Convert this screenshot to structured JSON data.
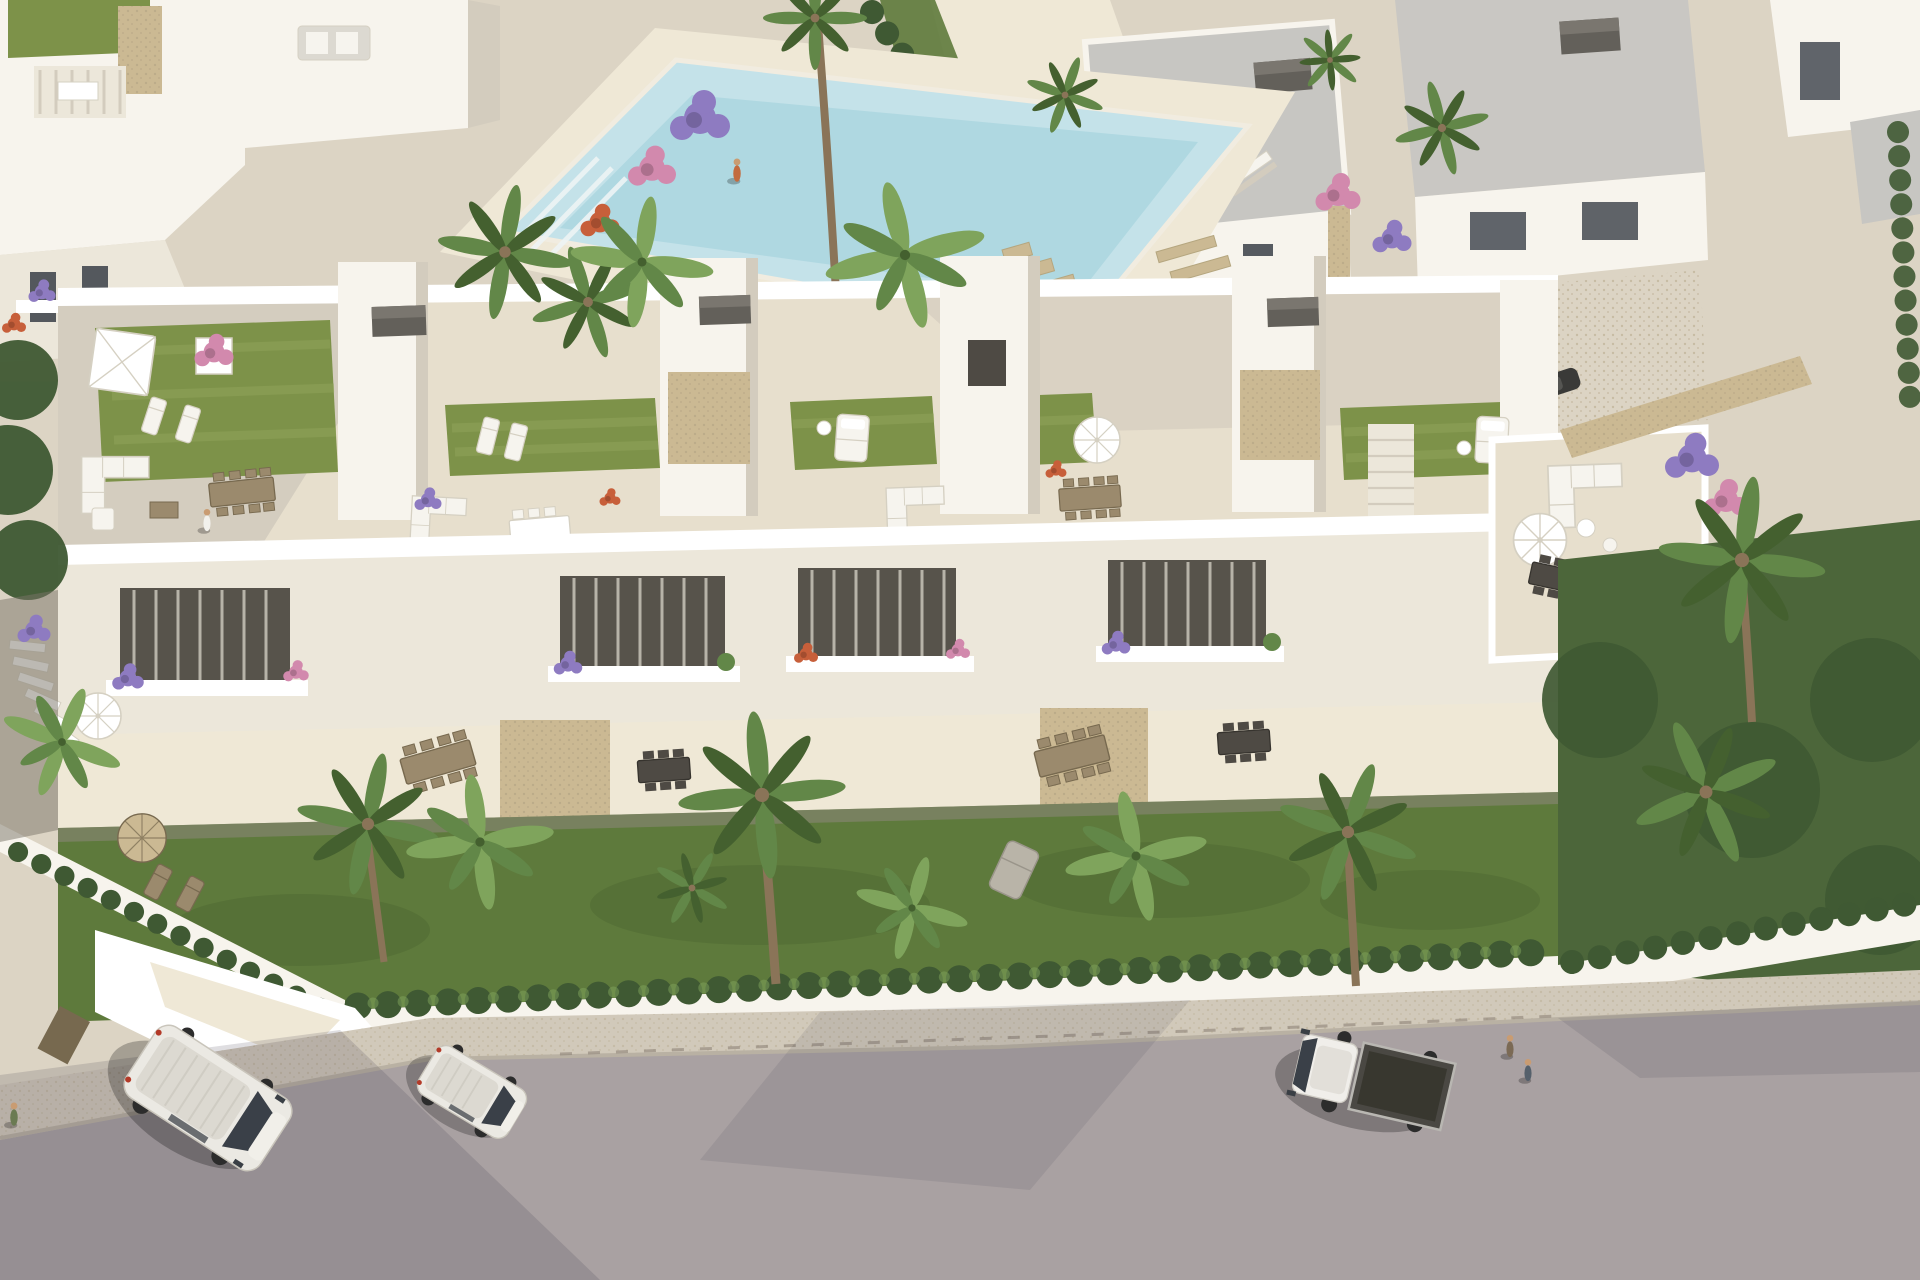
{
  "meta": {
    "content_type": "aerial-architectural-render",
    "description": "High-angle aerial 3D visualization of a modern white residential complex: a row of townhouses with landscaped roof terraces, balcony level with flower planters, ground-floor terraces and private gardens, a communal swimming pool with palm landscaping behind, surrounding white villas, and a front street with parked vehicles. Warm low sun casts long shadows toward the lower left.",
    "no_visible_text": true
  },
  "palette": {
    "ground": "#dcd4c4",
    "deck": "#e7dfcd",
    "deckLight": "#efe8d6",
    "wallLit": "#f7f4ed",
    "wallWhite": "#ffffff",
    "wallMid": "#ece7da",
    "wallShadow": "#d3ccbe",
    "roofGrey": "#c7c6c2",
    "roofDark": "#8f8d89",
    "grassRoof": "#7d9249",
    "grassStripe": "#94a75d",
    "grassLawn": "#5e7a3c",
    "lawnDark": "#49622f",
    "hedge": "#3f5933",
    "palm": "#628748",
    "palmLight": "#7fa45c",
    "palmDark": "#44602f",
    "trunk": "#8a7458",
    "pool": "#c4e2e9",
    "poolDeep": "#9fcfdb",
    "stone": "#cbb993",
    "pebDot": "#b2a384",
    "wood": "#9b8a6d",
    "woodDark": "#77694f",
    "charcoal": "#4e4a44",
    "boxGrey": "#63605a",
    "boxGreyTop": "#7a766f",
    "road": "#a9a1a2",
    "sidewalk": "#d1c9ba",
    "curb": "#b9b1a3",
    "shadowTint": "#353144",
    "white": "#f6f4ee",
    "furnEdge": "#d5d0c2",
    "flowerPurple": "#8e7bc1",
    "flowerPink": "#d289ad",
    "flowerRed": "#c75f3a",
    "carBlue": "#5b7eb2",
    "glass": "#3a4048",
    "skin": "#c99c72",
    "vanBody": "#ebe9e3",
    "vanRoof": "#dcd9d1",
    "truckBed": "#4a4843",
    "redLight": "#b33a28"
  },
  "scene": {
    "background": {
      "left_villas": "white flat-roofed villas with roof lawns, pergola terrace and stone stair tower",
      "right_villas": "two-storey white villas with grey flat roofs, stone-clad corners, dark garage and window openings",
      "pool": {
        "shape": "rotated rectangle",
        "water_color": "light turquoise",
        "features": [
          "corner entry steps",
          "stone stepping blocks",
          "palm and flower planters",
          "pale stone deck"
        ]
      },
      "walkway": "pale stone path between lawns and clipped cypress hedges",
      "ornaments": [
        "round boulder",
        "timber bench"
      ]
    },
    "main_building": {
      "type": "row of modern white townhouses",
      "levels": [
        "roof terraces with artificial lawn",
        "balcony level with glass rails and flower planters",
        "ground-floor terraces",
        "private front gardens"
      ],
      "roof_terraces": [
        {
          "furniture": [
            "square white parasol",
            "two sun loungers",
            "flowering tree planter",
            "grey corner sofa",
            "timber dining table",
            "person walking"
          ]
        },
        {
          "furniture": [
            "white loungers",
            "white dining table",
            "corner sofas",
            "stone-clad stair core"
          ]
        },
        {
          "furniture": [
            "white day bed on lawn",
            "spoked white parasol",
            "timber dining table"
          ]
        },
        {
          "furniture": [
            "white day bed",
            "lawn",
            "white stool"
          ]
        },
        {
          "furniture": [
            "white corner sofa",
            "dark dining set",
            "cream parasol",
            "two people"
          ]
        }
      ],
      "accents": [
        "stone-clad panels",
        "grey storage boxes",
        "central white staircase"
      ]
    },
    "foreground": {
      "gardens": [
        "lawns",
        "tan garden parasol with timber loungers",
        "grey chaise longue",
        "outdoor dining tables"
      ],
      "planting": [
        "cypress hedge row on white wall",
        "fan palms",
        "banana palms",
        "purple and pink flower planters"
      ],
      "boundary": "white perimeter wall with corner courtyard and timber gate"
    },
    "street": {
      "surface": "grey asphalt",
      "sidewalk": "pebbled pale pavement with dashed fence shadow",
      "vehicles": [
        {
          "type": "panel van",
          "color": "white",
          "position": "left, parked at angle"
        },
        {
          "type": "compact van",
          "color": "white",
          "position": "left of center"
        },
        {
          "type": "flatbed truck",
          "color": "white cab with dark grey bed",
          "position": "right"
        },
        {
          "type": "hatchback",
          "color": "blue",
          "position": "background driveway by villas"
        },
        {
          "type": "car",
          "color": "dark grey",
          "position": "partially hidden by background garage"
        }
      ]
    },
    "people": {
      "count": 8,
      "activities": [
        "walking on roof terrace",
        "walking beside the pool",
        "standing on right terrace",
        "walking along the street"
      ]
    },
    "lighting": {
      "sun": "low, from upper right",
      "shadows": "long, cast to lower left"
    }
  }
}
